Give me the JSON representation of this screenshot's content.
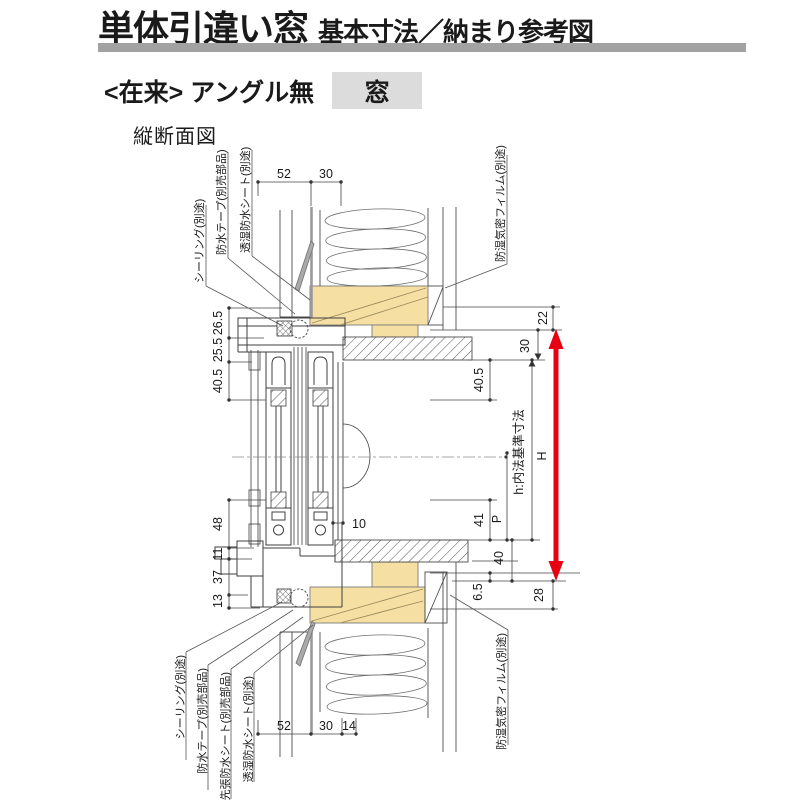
{
  "page": {
    "title_main": "単体引違い窓",
    "title_sub": "基本寸法／納まり参考図",
    "condition_prefix": "<在来> アングル無",
    "condition_highlight": "窓",
    "section_label": "縦断面図"
  },
  "colors": {
    "rule_gray": "#a2a2a2",
    "highlight_bg": "#dcdcdc",
    "wood_fill": "#f5dfa2",
    "arrow_red": "#e60012",
    "line": "#4d4d4d"
  },
  "drawing": {
    "labels": {
      "top_left": [
        "シーリング(別途)",
        "防水テープ(別売部品)",
        "透湿防水シート(別途)"
      ],
      "top_right": "防湿気密フィルム(別途)",
      "bottom_left": [
        "シーリング(別途)",
        "防水テープ(別売部品)",
        "先張防水シート(別売部品)",
        "透湿防水シート(別途)"
      ],
      "bottom_right": "防湿気密フィルム(別途)"
    },
    "dims": {
      "top": [
        "52",
        "30"
      ],
      "bottom": [
        "52",
        "30",
        "14"
      ],
      "left_upper": [
        "26.5",
        "25.5",
        "40.5"
      ],
      "left_lower": [
        "48",
        "11",
        "37",
        "13"
      ],
      "inner_10": "10",
      "right": {
        "d22": "22",
        "d30": "30",
        "d405": "40.5",
        "d41": "41",
        "p": "P",
        "d40": "40",
        "d65": "6.5",
        "d28": "28",
        "h_label": "h:内法基準寸法",
        "H": "H"
      }
    }
  }
}
